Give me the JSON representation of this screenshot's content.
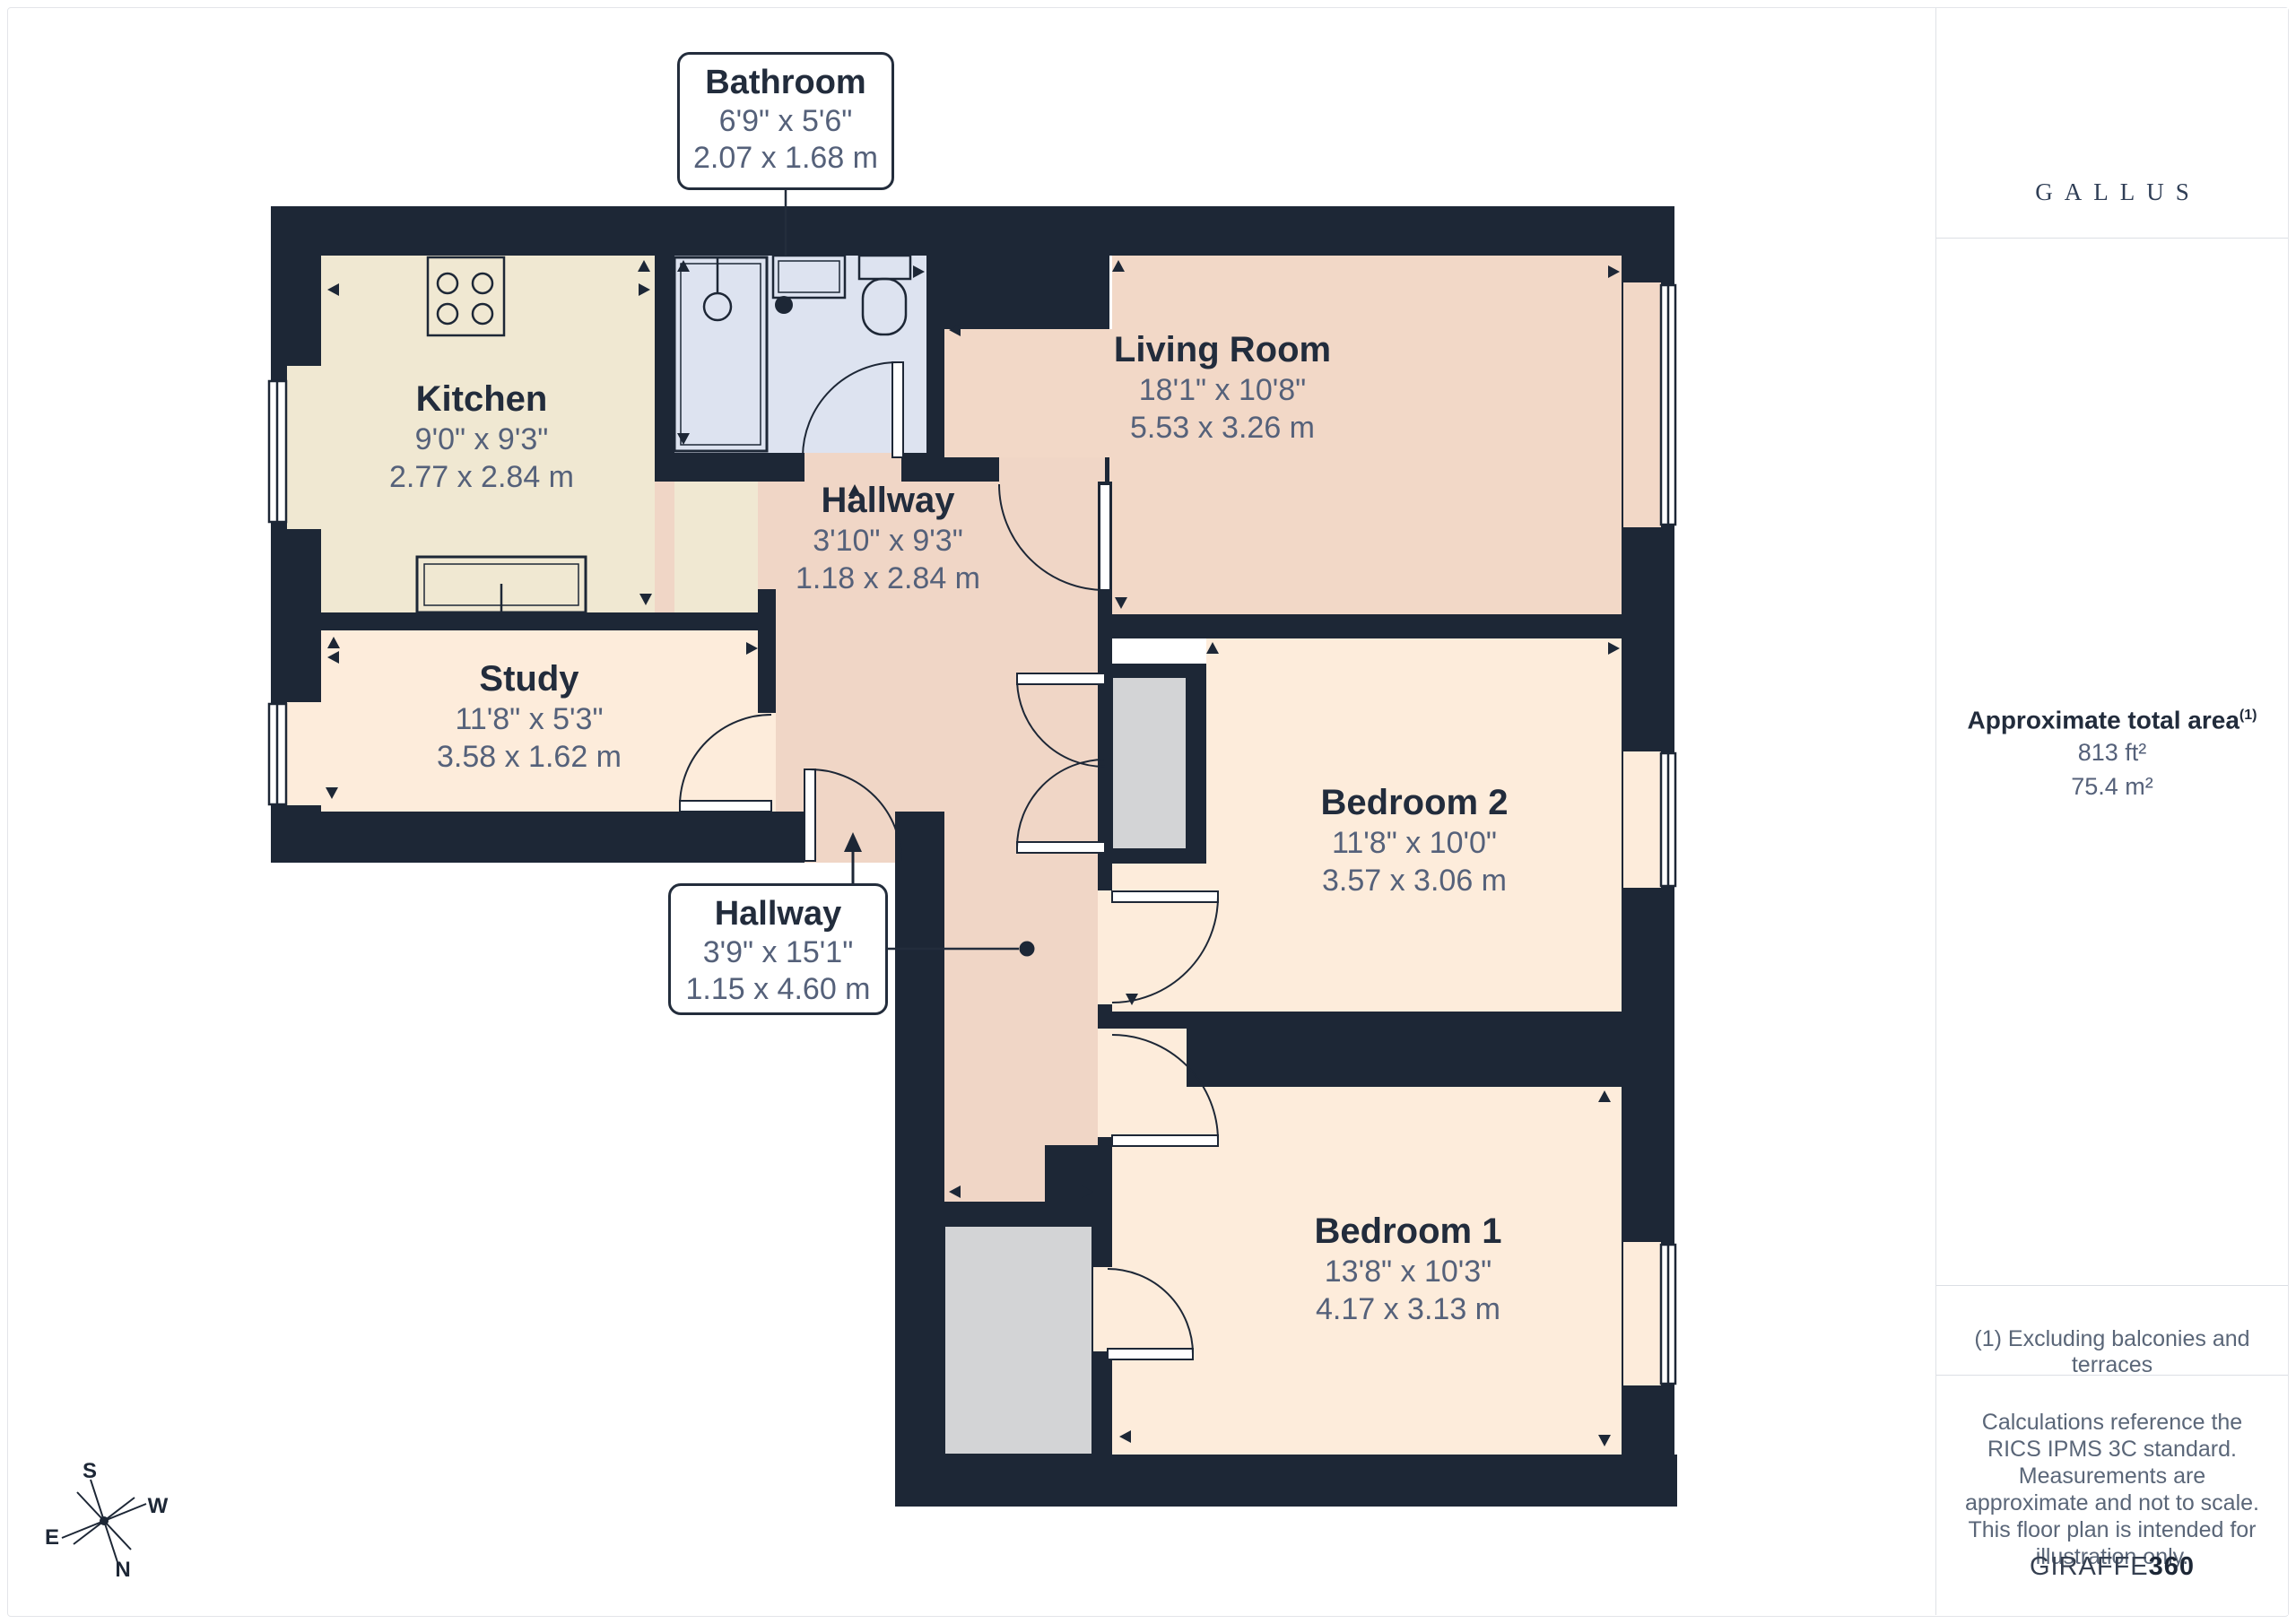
{
  "plan": {
    "rooms": [
      {
        "id": "kitchen",
        "name": "Kitchen",
        "imperial": "9'0\" x 9'3\"",
        "metric": "2.77 x 2.84 m"
      },
      {
        "id": "study",
        "name": "Study",
        "imperial": "11'8\" x 5'3\"",
        "metric": "3.58 x 1.62 m"
      },
      {
        "id": "living-room",
        "name": "Living Room",
        "imperial": "18'1\" x 10'8\"",
        "metric": "5.53 x 3.26 m"
      },
      {
        "id": "hallway-upper",
        "name": "Hallway",
        "imperial": "3'10\" x 9'3\"",
        "metric": "1.18 x 2.84 m"
      },
      {
        "id": "bedroom-2",
        "name": "Bedroom 2",
        "imperial": "11'8\" x 10'0\"",
        "metric": "3.57 x 3.06 m"
      },
      {
        "id": "bedroom-1",
        "name": "Bedroom 1",
        "imperial": "13'8\" x 10'3\"",
        "metric": "4.17 x 3.13 m"
      }
    ],
    "callouts": [
      {
        "id": "bathroom",
        "name": "Bathroom",
        "imperial": "6'9\" x 5'6\"",
        "metric": "2.07 x 1.68 m"
      },
      {
        "id": "hallway-lower",
        "name": "Hallway",
        "imperial": "3'9\" x 15'1\"",
        "metric": "1.15 x 4.60 m"
      }
    ],
    "compass": {
      "n": "N",
      "s": "S",
      "e": "E",
      "w": "W"
    }
  },
  "sidebar": {
    "logo": {
      "brand": "GALLUS"
    },
    "area": {
      "title": "Approximate total area",
      "title_sup": "(1)",
      "imperial": "813 ft²",
      "metric": "75.4 m²"
    },
    "footnote": "(1) Excluding balconies and terraces",
    "disclaimer": "Calculations reference the RICS IPMS 3C standard. Measurements are approximate and not to scale. This floor plan is intended for illustration only.",
    "credit": {
      "brand": "GIRAFFE",
      "suffix": "360"
    }
  },
  "colors": {
    "wall": "#1d2736",
    "kitchen": "#f0e8d2",
    "bathroom": "#dde3f0",
    "pink": "#f2d8c7",
    "peach": "#fdecdb",
    "closet": "#d3d4d6",
    "gold": "#d4aa56",
    "dim_text": "#55617a",
    "title_text": "#222c3c"
  }
}
